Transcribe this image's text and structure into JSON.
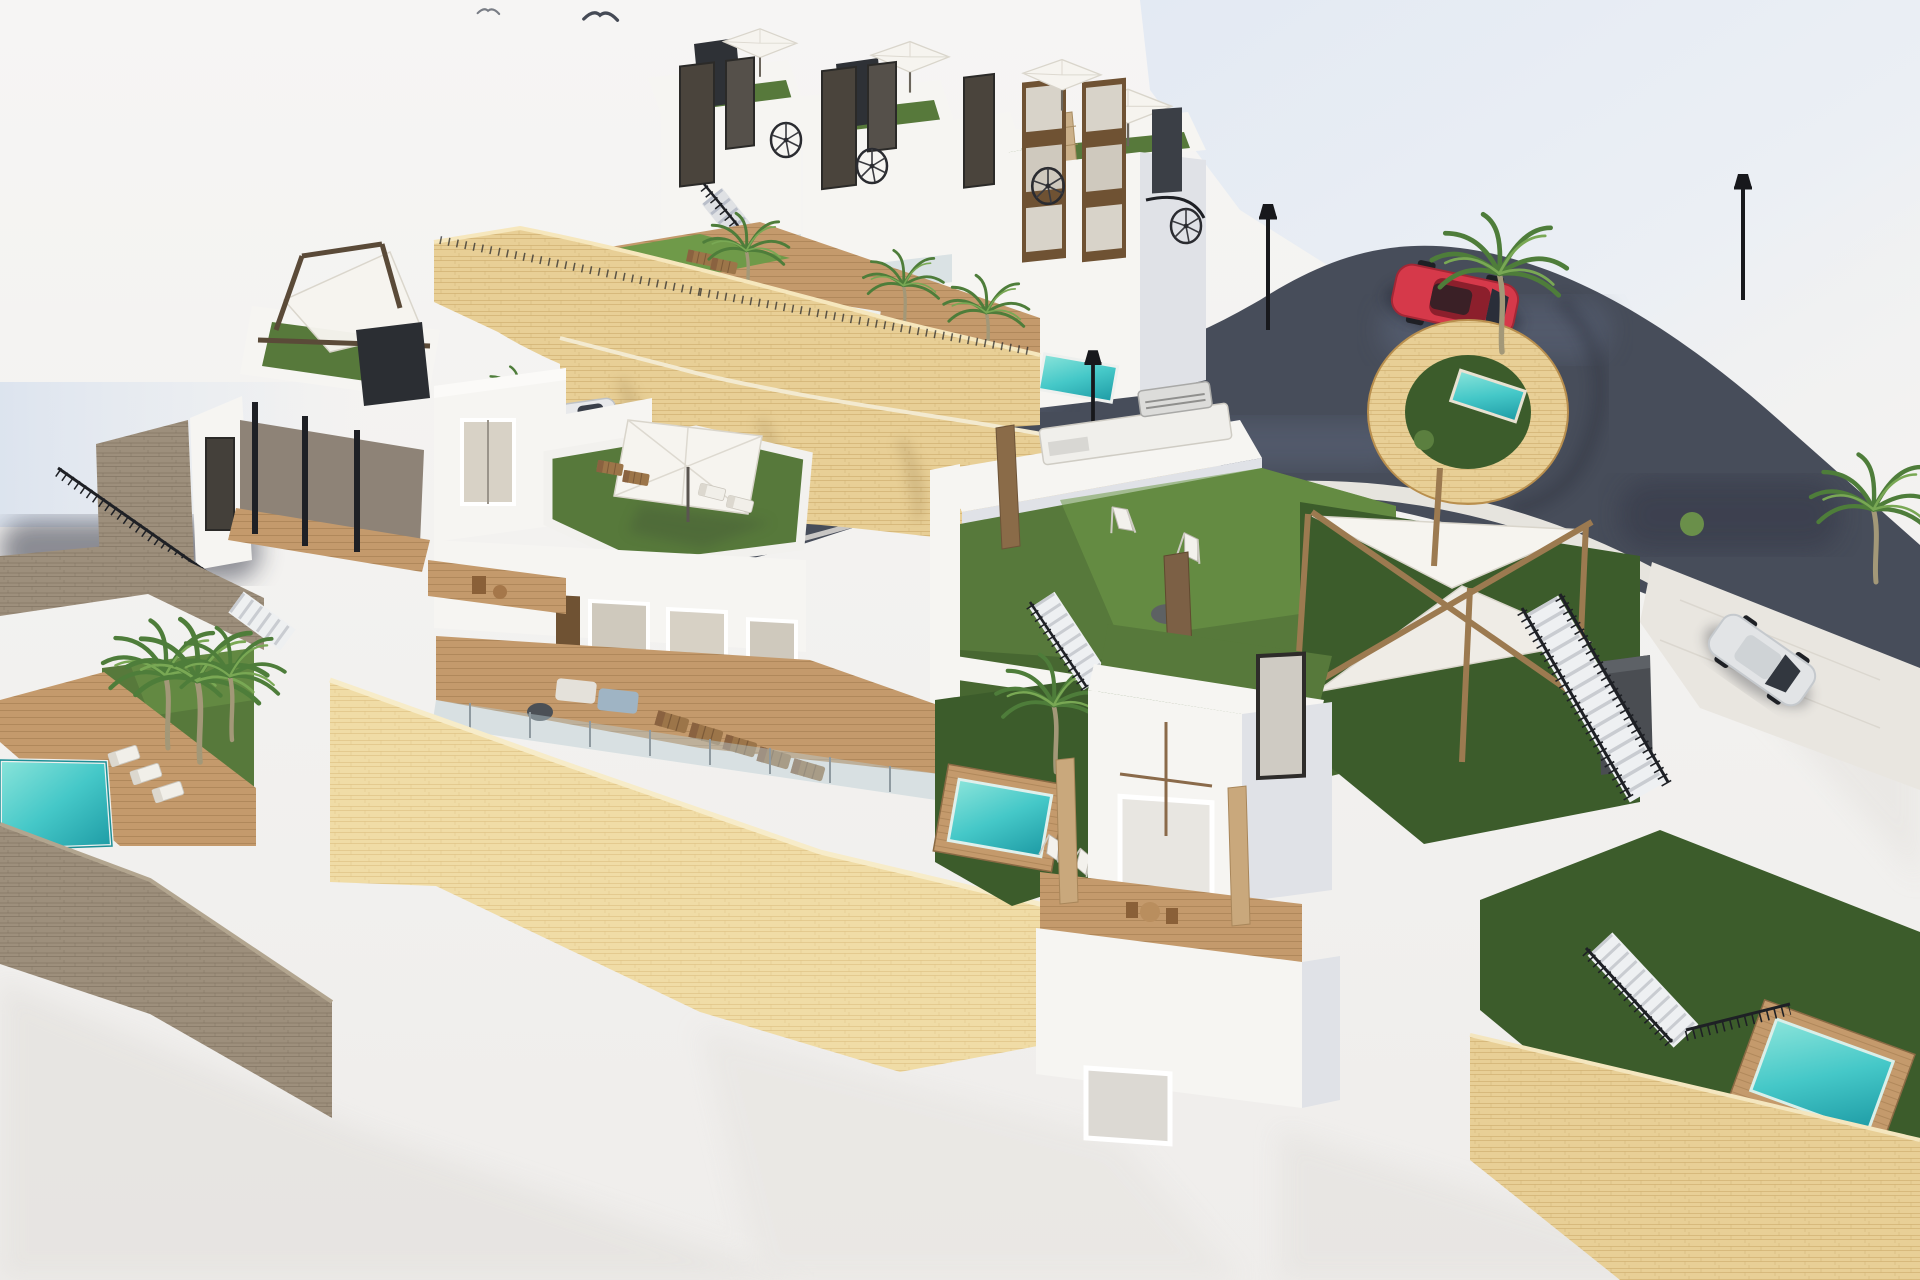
{
  "scene": {
    "type": "aerial-3d-architectural-rendering",
    "description": "Bird's-eye 3D visualization of a hillside residential development of white modern villas and townhouses with rooftop terraces, artificial-grass gardens, private plunge pools, wooden sun decks, sandstone retaining walls and a curved asphalt access road with parking.",
    "time_of_day": "bright daylight, hazy white sky",
    "buildings": [
      {
        "name": "townhouse-row",
        "location": "upper middle",
        "features": [
          "rooftop solariums with artificial grass",
          "white parasols",
          "black spiral staircases",
          "dark chimney volumes",
          "communal pool terrace with brown sun loungers"
        ]
      },
      {
        "name": "tall-apartment-building",
        "location": "upper right",
        "features": [
          "brown spandrel window strips",
          "roof garden edge",
          "white parasol",
          "spiral staircase"
        ]
      },
      {
        "name": "left-villa",
        "location": "left",
        "features": [
          "roof terrace with shade-sail pergola",
          "dark chimney",
          "wooden under-deck",
          "slim black columns"
        ]
      },
      {
        "name": "center-villa",
        "location": "center",
        "features": [
          "green roof solarium",
          "large square white parasol",
          "sun loungers",
          "wooden balcony",
          "large shared wood deck with lounge sofa and loungers"
        ]
      },
      {
        "name": "garden-villa",
        "location": "center right",
        "features": [
          "large artificial lawn",
          "BBQ grill island",
          "two folding deck chairs",
          "gray pouf",
          "brown tiled pillars",
          "timber X-frame pergola with white shade sails",
          "slate outdoor-kitchen monolith"
        ]
      },
      {
        "name": "bottom-center-villa",
        "location": "bottom center",
        "features": [
          "green roof",
          "wooden balconies with bistro sets",
          "private garden with plunge pool and palm",
          "tiled timber columns"
        ]
      },
      {
        "name": "right-plot",
        "location": "right",
        "features": [
          "private driveway with parked white car",
          "external staircases with black railings",
          "lower garden with wood-rimmed plunge pool"
        ]
      }
    ],
    "pools": [
      {
        "name": "communal-pool-upper-terrace",
        "location": "upper middle-left"
      },
      {
        "name": "small-pool-townhouse-1",
        "location": "upper middle"
      },
      {
        "name": "small-pool-townhouse-2",
        "location": "upper middle-right"
      },
      {
        "name": "planter-ring-pool",
        "location": "right of tall building, inside curved stone ring"
      },
      {
        "name": "bottom-left-pool",
        "location": "lower left terrace"
      },
      {
        "name": "private-garden-pool",
        "location": "bottom center villa garden"
      },
      {
        "name": "bottom-right-pool",
        "location": "bottom right garden, wood rim"
      }
    ],
    "vehicles": [
      {
        "name": "red-sports-car",
        "location": "top-right parking area"
      },
      {
        "name": "dark-sedan",
        "location": "center parking niche"
      },
      {
        "name": "red-suv",
        "location": "center-left behind wall"
      },
      {
        "name": "white-sports-car",
        "location": "center-left behind wall"
      },
      {
        "name": "white-hatchback",
        "location": "right driveway"
      }
    ],
    "landscape": {
      "palm_trees": 14,
      "street_lamps": 4,
      "parasols": 4,
      "spiral_staircases": 4,
      "shade_sail_pergolas": 2,
      "bbq_grills": 1,
      "birds": 2,
      "retaining_walls": [
        "yellow sandstone curved walls across the slope",
        "gray-taupe stone walls on the lower left",
        "bright sunlit sandstone wall across bottom center",
        "sandstone wall bottom right"
      ],
      "road": "dark asphalt lane sweeping from center-left to a top-right parking lot and down the right side"
    }
  },
  "palette": {
    "background": "#f3f2f0",
    "sky_haze": "#e2e9f3",
    "road_asphalt": "#474d5a",
    "road_light": "#5b6579",
    "road_dark": "#343947",
    "sandstone": "#e8cf96",
    "sandstone_bright": "#f0dca6",
    "sandstone_dark": "#c9a866",
    "gray_stone": "#9d8f7c",
    "gray_stone_dark": "#7a6c5b",
    "wall_white": "#f6f5f2",
    "wall_shade": "#e0e2e7",
    "wall_deep_shade": "#b9bec9",
    "lawn": "#57793b",
    "lawn_bright": "#6f9a49",
    "lawn_dark": "#3c5c2b",
    "pool_water": "#3fc4c4",
    "pool_deep": "#1d9aa4",
    "wood_deck": "#c49a6c",
    "wood_dark": "#9c7549",
    "metal_black": "#1e2025",
    "pergola_bronze": "#9c7a50",
    "umbrella_white": "#f6f4ef",
    "car_red": "#d6394a",
    "car_dark": "#23262b",
    "suv_red": "#b23431",
    "car_white": "#e2e4e6",
    "palm_green": "#4e7d3a",
    "palm_light": "#79a854",
    "trunk": "#a39878"
  }
}
